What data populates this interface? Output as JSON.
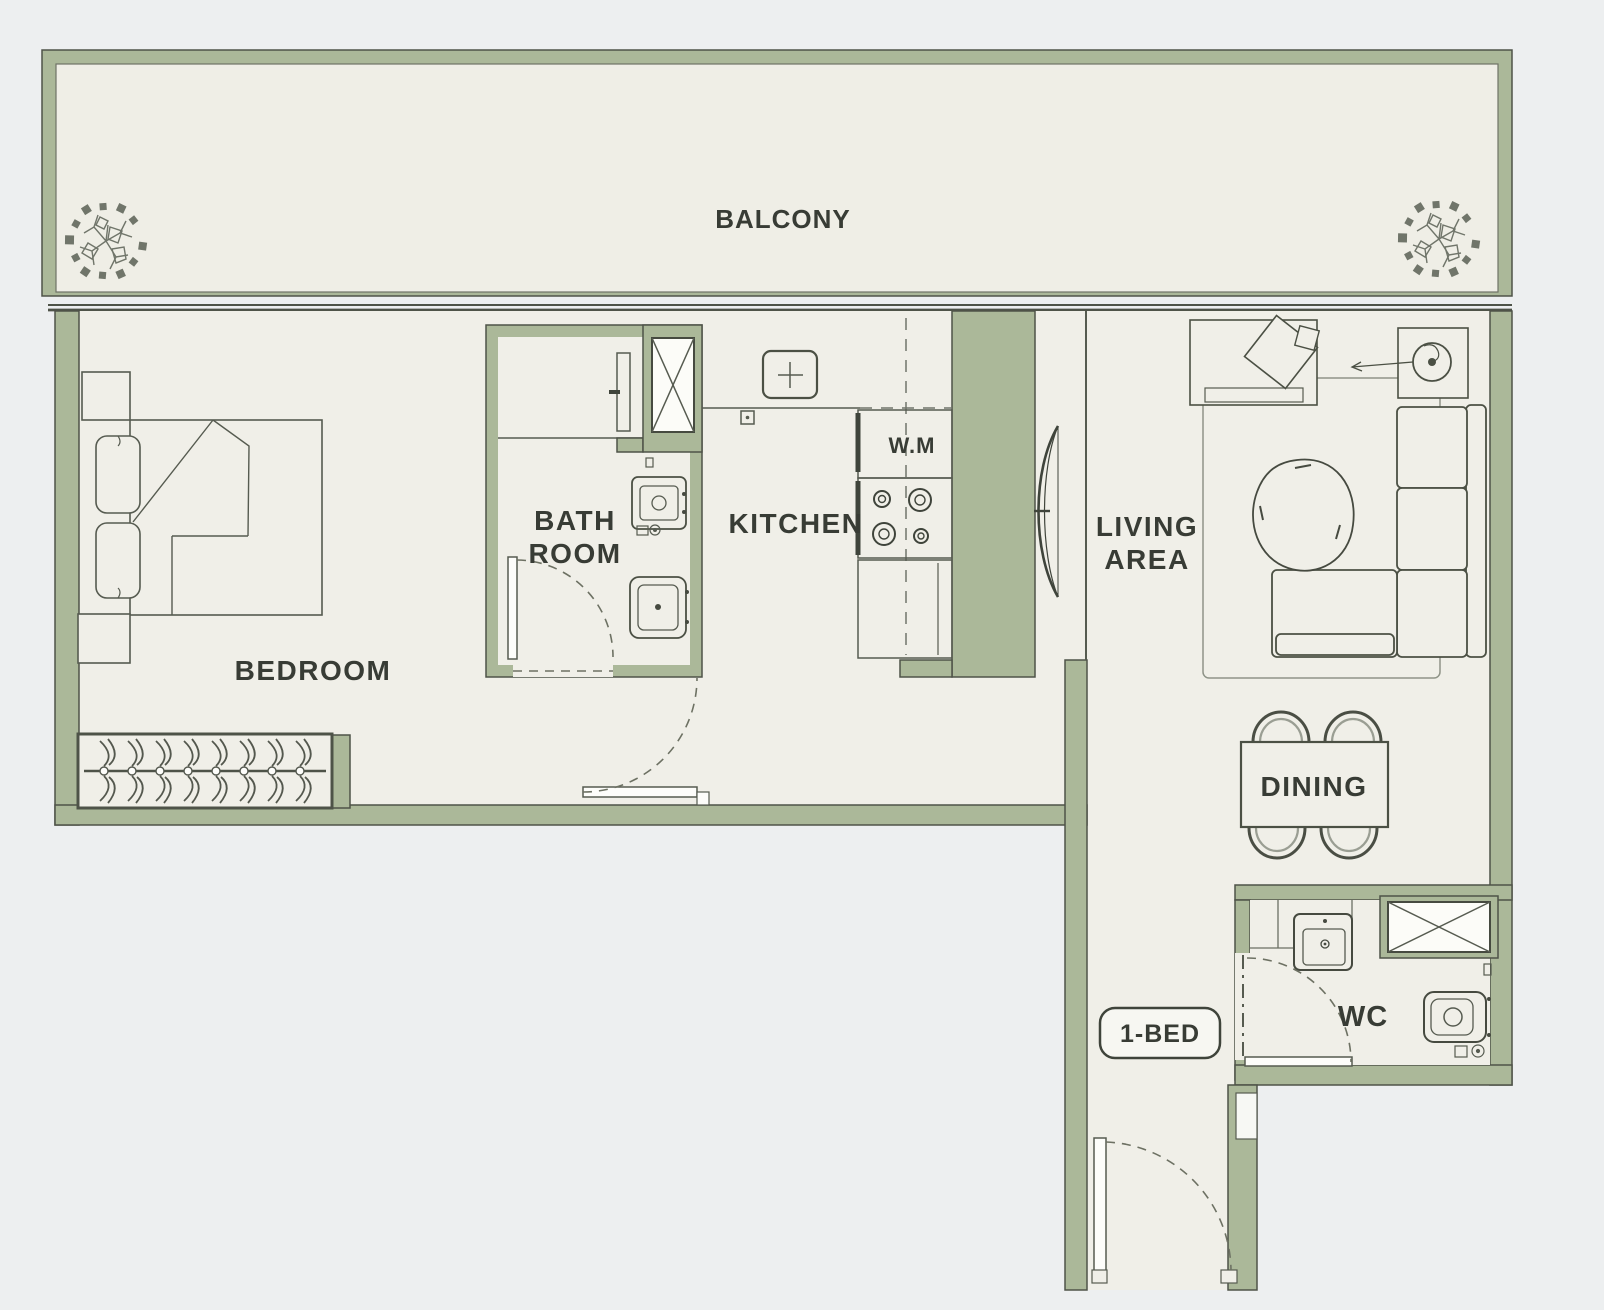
{
  "plan": {
    "type": "apartment-floor-plan",
    "unit_badge": "1-BED",
    "rooms": {
      "balcony": {
        "label": "BALCONY"
      },
      "bedroom": {
        "label": "BEDROOM"
      },
      "bathroom": {
        "label_line1": "BATH",
        "label_line2": "ROOM"
      },
      "kitchen": {
        "label": "KITCHEN"
      },
      "washing_machine": {
        "label": "W.M"
      },
      "living": {
        "label_line1": "LIVING",
        "label_line2": "AREA"
      },
      "dining": {
        "label": "DINING"
      },
      "wc": {
        "label": "WC"
      }
    },
    "colors": {
      "background": "#edeff0",
      "floor": "#f0efe8",
      "wall_fill": "#abb899",
      "wall_outline": "#4e5348",
      "line": "#565b50",
      "text": "#383c35"
    }
  }
}
